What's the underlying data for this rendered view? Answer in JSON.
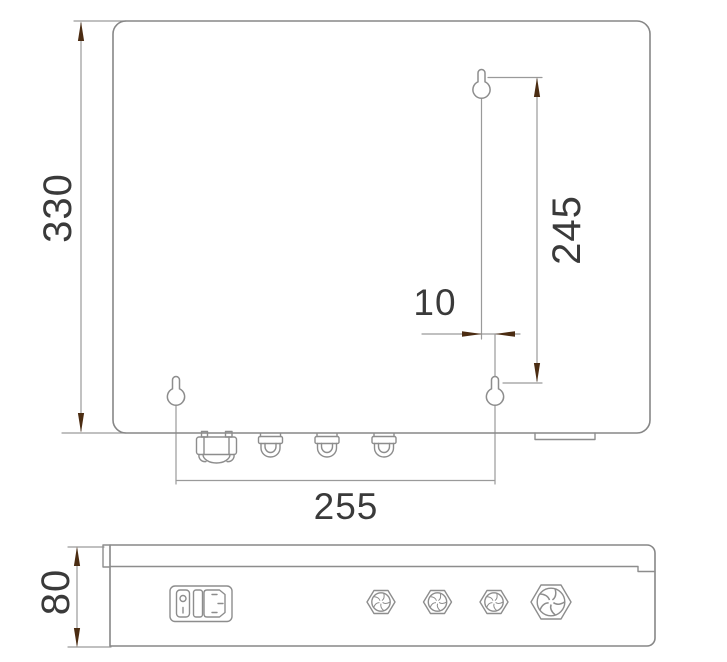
{
  "drawing": {
    "type": "enclosure-dimension-drawing",
    "labels": {
      "height": "330",
      "hole_spacing_vertical": "245",
      "hole_offset": "10",
      "hole_spacing_horizontal": "255",
      "depth": "80"
    },
    "colors": {
      "outline": "#878787",
      "dimension_line": "#9a9a9a",
      "arrow": "#4b2c12",
      "text": "#3a3a3a",
      "background": "#ffffff"
    }
  }
}
